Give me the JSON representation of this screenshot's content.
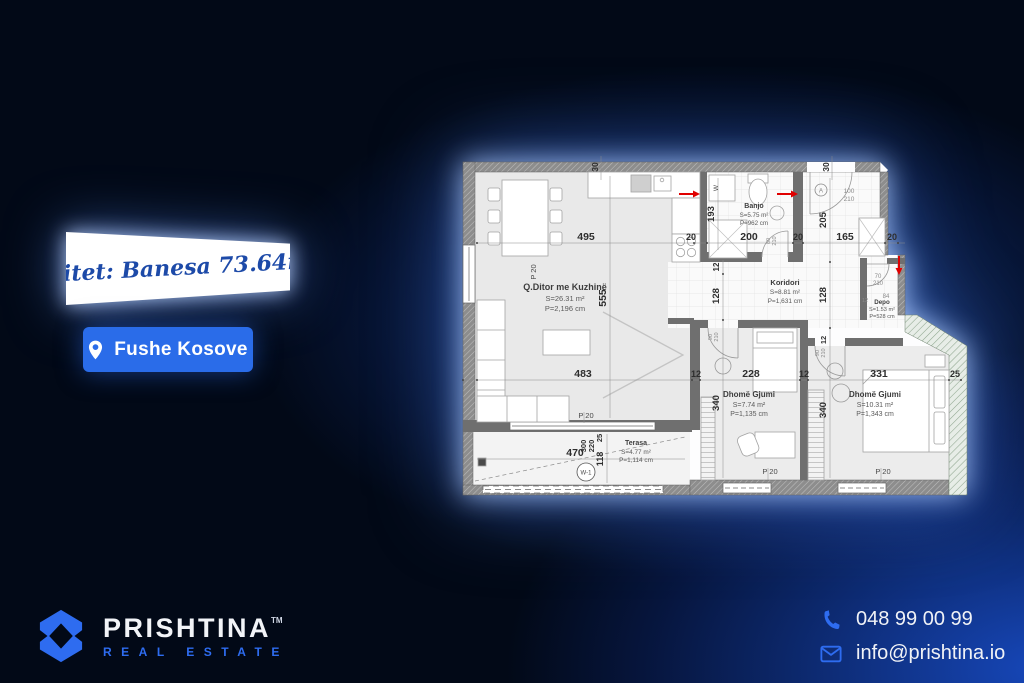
{
  "banner": {
    "text": "Shitet: Banesa 73.64m2"
  },
  "location_button": {
    "label": "Fushe Kosove",
    "icon": "location-pin"
  },
  "brand": {
    "name": "PRISHTINA",
    "trademark": "TM",
    "tagline": "REAL ESTATE"
  },
  "contact": {
    "phone": "048 99 00 99",
    "email": "info@prishtina.io"
  },
  "colors": {
    "accent_blue": "#2a6ce9",
    "banner_text_blue": "#1d4aa8",
    "background_navy": "#020917",
    "plan_red": "#e00000"
  },
  "floorplan": {
    "rooms": [
      {
        "name": "Q.Ditor me Kuzhinë",
        "area": "S=26.31 m²",
        "perimeter": "P=2,196 cm"
      },
      {
        "name": "Banjo",
        "area": "S=5.75 m²",
        "perimeter": "P=962 cm"
      },
      {
        "name": "Koridori",
        "area": "S=8.81 m²",
        "perimeter": "P=1,631 cm"
      },
      {
        "name": "Depo",
        "area": "S=1.53 m²",
        "perimeter": "P=528 cm"
      },
      {
        "name": "Dhomë Gjumi",
        "area": "S=7.74 m²",
        "perimeter": "P=1,135 cm"
      },
      {
        "name": "Dhomë Gjumi",
        "area": "S=10.31 m²",
        "perimeter": "P=1,343 cm"
      },
      {
        "name": "Terasa",
        "area": "S=4.77 m²",
        "perimeter": "P=1,114 cm"
      }
    ],
    "dims": {
      "d30": "30",
      "d495": "495",
      "d20": "20",
      "d200": "200",
      "d165": "165",
      "d555": "555",
      "d193": "193",
      "d205": "205",
      "d12": "12",
      "d128": "128",
      "d483": "483",
      "d228": "228",
      "d331": "331",
      "d25": "25",
      "d340": "340",
      "d470": "470",
      "d118": "118",
      "d220": "220",
      "d300": "300",
      "d84": "84"
    },
    "doors": {
      "entrance_w": "100",
      "entrance_h": "210",
      "banjo_w": "80",
      "banjo_h": "210",
      "bed_w": "90",
      "bed_h": "210",
      "depo_w": "70",
      "depo_h": "210"
    },
    "tags": {
      "p20": "P 20",
      "w1": "W-1",
      "w": "W",
      "a": "A"
    }
  }
}
